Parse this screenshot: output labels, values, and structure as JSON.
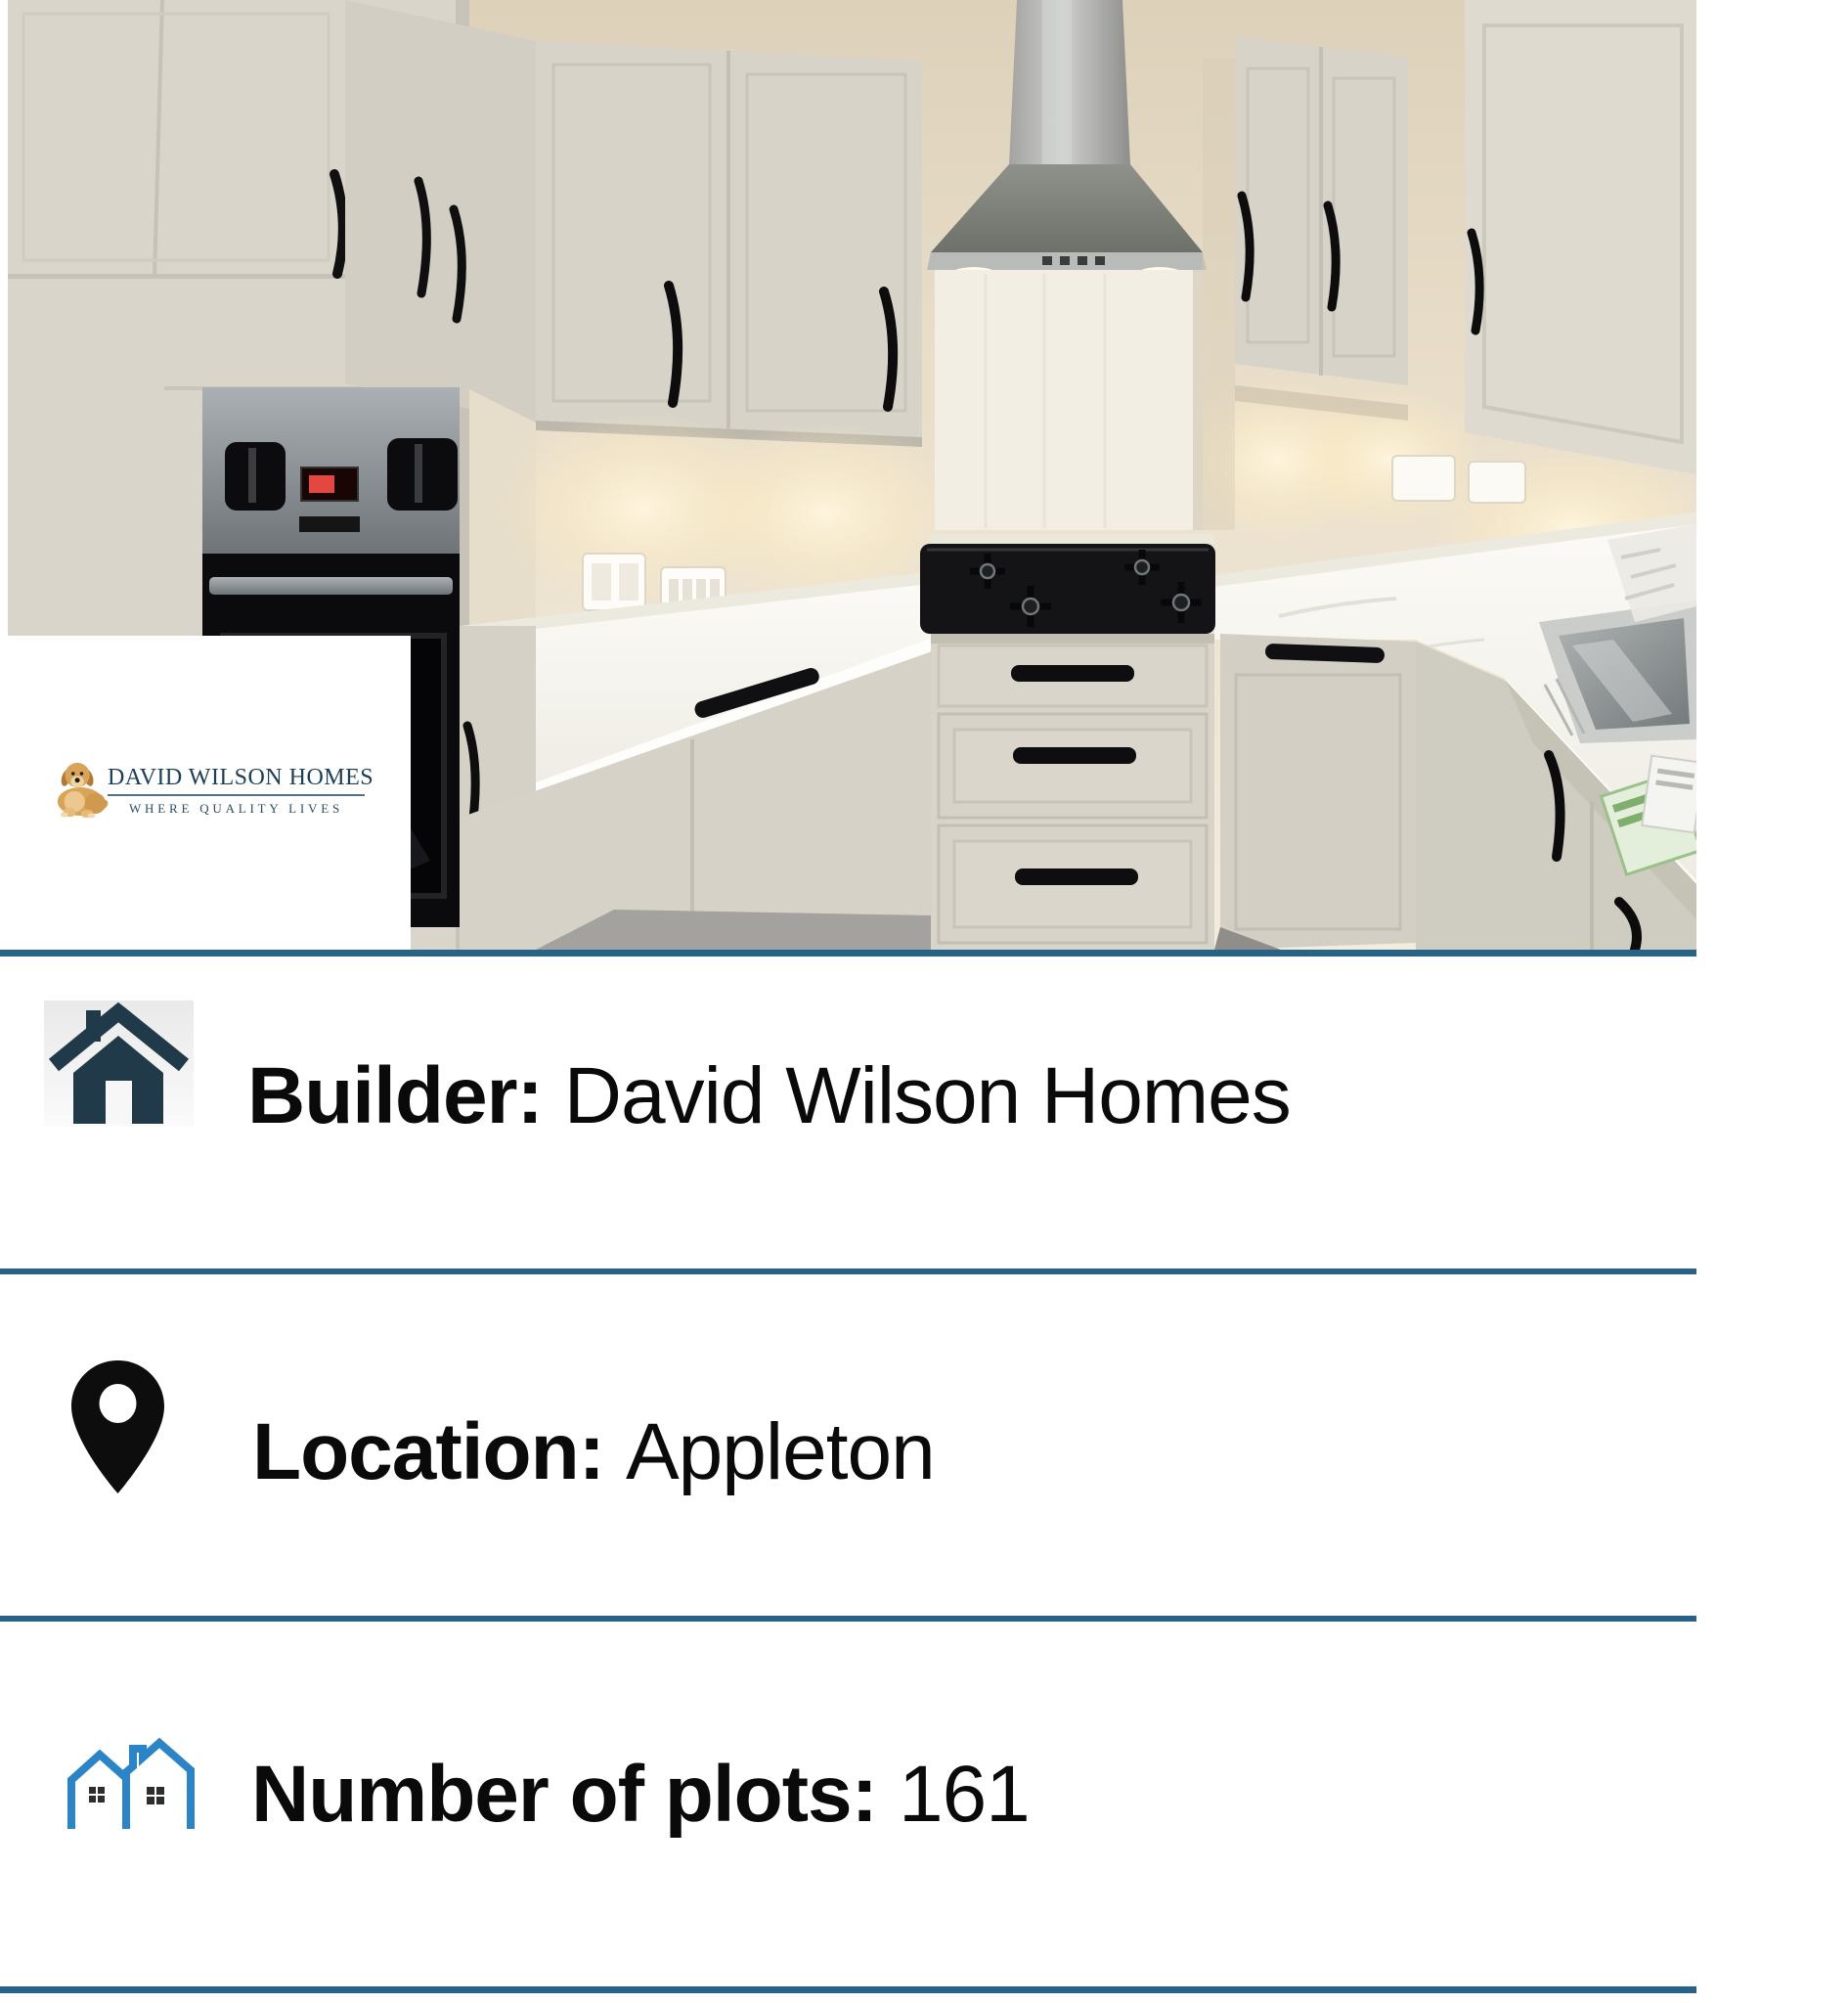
{
  "logo": {
    "brand": "DAVID WILSON HOMES",
    "tagline": "WHERE QUALITY LIVES"
  },
  "rows": [
    {
      "id": "builder",
      "icon": "home-icon",
      "label": "Builder:",
      "value": "David Wilson Homes"
    },
    {
      "id": "location",
      "icon": "location-pin-icon",
      "label": "Location:",
      "value": "Appleton"
    },
    {
      "id": "plots",
      "icon": "houses-icon",
      "label": "Number of plots:",
      "value": "161"
    }
  ],
  "colors": {
    "divider_teal": "#276287",
    "home_icon_navy": "#213a4a",
    "houses_icon_blue": "#2b84c6",
    "logo_navy": "#1e3e55",
    "row_text": "#0a0a0a"
  }
}
